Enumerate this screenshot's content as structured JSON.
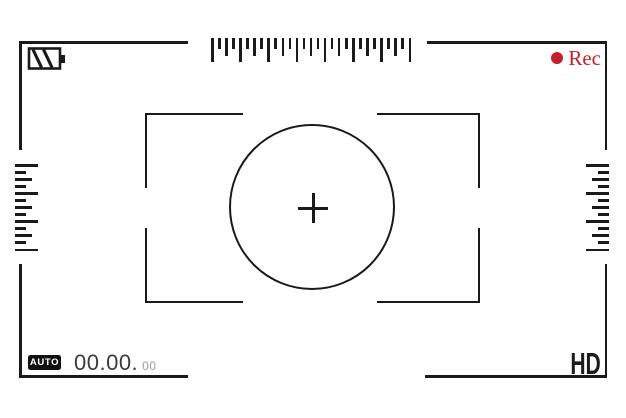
{
  "scene": {
    "title": "Camera viewfinder screen",
    "background": "#ffffff",
    "frame_color": "#1a1a1a"
  },
  "top_bar": {
    "battery_icon": "battery-icon (striped, charge indicator)",
    "rec": {
      "label": "Rec",
      "color": "#c41f2d"
    }
  },
  "rulers": {
    "top": {
      "orientation": "horizontal",
      "tick_count": 29,
      "pattern": [
        "long",
        "short",
        "medium",
        "short"
      ]
    },
    "left": {
      "orientation": "vertical",
      "tick_count": 13,
      "pattern": [
        "long",
        "short",
        "medium",
        "short"
      ]
    },
    "right": {
      "orientation": "vertical",
      "tick_count": 13,
      "pattern": [
        "long",
        "short",
        "medium",
        "short"
      ]
    }
  },
  "focus_area": {
    "brackets": "four corner brackets with center gaps",
    "circle_icon": "focus-circle",
    "crosshair_icon": "crosshair"
  },
  "bottom_bar": {
    "mode_badge": "AUTO",
    "timecode": {
      "main": "00.00.",
      "frames": "00",
      "main_color": "#3b3b3b",
      "frames_color": "#9b9b9b"
    },
    "quality": "HD"
  }
}
